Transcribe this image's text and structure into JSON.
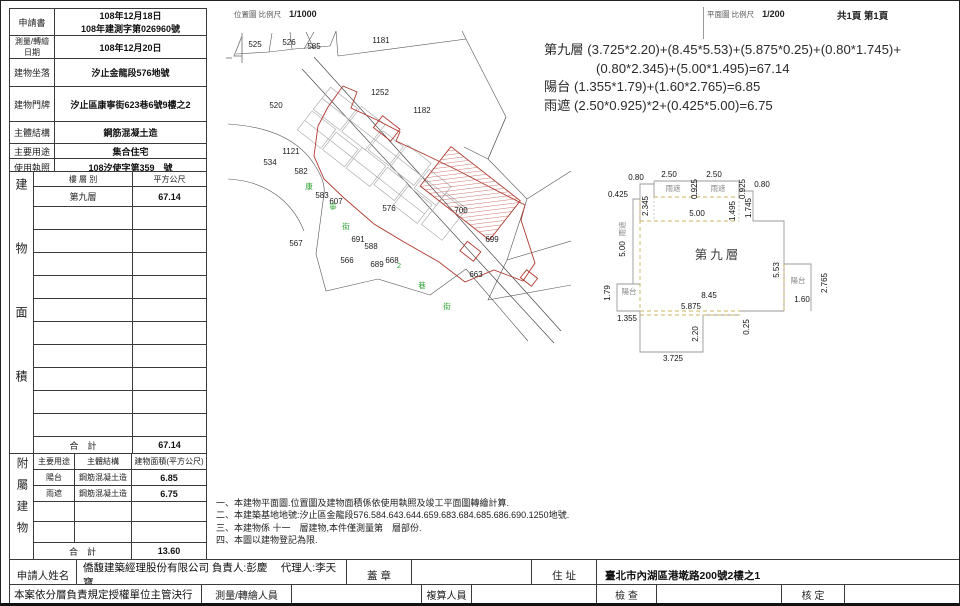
{
  "page": {
    "title_location": "位置圖 比例尺",
    "scale_location": "1/1000",
    "title_plan": "平面圖 比例尺",
    "scale_plan": "1/200",
    "page_info": "共1頁 第1頁"
  },
  "info_table": {
    "rows": [
      {
        "label": "申請書",
        "value": "108年12月18日",
        "value2": "108年建測字第026960號"
      },
      {
        "label": "測量/轉繪日期",
        "value": "108年12月20日"
      },
      {
        "label": "建物坐落",
        "value": "汐止金龍段576地號"
      },
      {
        "label": "建物門牌",
        "value": "汐止區康寧街623巷6號9樓之2"
      },
      {
        "label": "主體結構",
        "value": "鋼筋混凝土造"
      },
      {
        "label": "主要用途",
        "value": "集合住宅"
      },
      {
        "label": "使用執照",
        "value": "108汐使字第359　號"
      }
    ]
  },
  "area_table": {
    "side_label": "建物面積",
    "col1": "樓 層 別",
    "col2": "平方公尺",
    "rows": [
      {
        "floor": "第九層",
        "area": "67.14"
      }
    ],
    "total_label": "合　計",
    "total": "67.14"
  },
  "annex_table": {
    "side_label": "附屬建物",
    "headers": [
      "主要用途",
      "主體結構",
      "建物面積(平方公尺)"
    ],
    "rows": [
      {
        "use": "陽台",
        "structure": "鋼筋混凝土造",
        "area": "6.85"
      },
      {
        "use": "雨遮",
        "structure": "鋼筋混凝土造",
        "area": "6.75"
      }
    ],
    "total_label": "合　計",
    "total": "13.60"
  },
  "formulas": {
    "line1": "第九層 (3.725*2.20)+(8.45*5.53)+(5.875*0.25)+(0.80*1.745)+",
    "line2": "(0.80*2.345)+(5.00*1.495)=67.14",
    "line3": "陽台 (1.355*1.79)+(1.60*2.765)=6.85",
    "line4": "雨遮 (2.50*0.925)*2+(0.425*5.00)=6.75"
  },
  "notes": {
    "line1": "一、本建物平面圖.位置圖及建物面積係依使用執照及竣工平面圖轉繪計算.",
    "line2": "二、本建築基地地號:汐止區金龍段576.584.643.644.659.683.684.685.686.690.1250地號.",
    "line3": "三、本建物係 十一　層建物,本件僅測量第　層部份.",
    "line4": "四、本圖以建物登記為限."
  },
  "footer": {
    "applicant_label": "申請人姓名",
    "applicant_value": "僑馥建築經理股份有限公司 負責人:彭慶　 代理人:李天寶",
    "seal_label": "蓋 章",
    "address_label": "住 址",
    "address_value": "臺北市內湖區港墘路200號2樓之1",
    "row2_left": "本案依分層負責規定授權單位主管決行",
    "surveyor_label": "測量/轉繪人員",
    "recheck_label": "複算人員",
    "inspect_label": "檢 查",
    "approve_label": "核 定"
  },
  "map": {
    "parcels": [
      {
        "t": "525",
        "x": 29,
        "y": 18
      },
      {
        "t": "526",
        "x": 63,
        "y": 16
      },
      {
        "t": "585",
        "x": 88,
        "y": 20
      },
      {
        "t": "1181",
        "x": 155,
        "y": 14
      },
      {
        "t": "520",
        "x": 50,
        "y": 79
      },
      {
        "t": "1252",
        "x": 154,
        "y": 66
      },
      {
        "t": "1182",
        "x": 196,
        "y": 84
      },
      {
        "t": "534",
        "x": 44,
        "y": 136
      },
      {
        "t": "1121",
        "x": 65,
        "y": 125
      },
      {
        "t": "582",
        "x": 75,
        "y": 145
      },
      {
        "t": "583",
        "x": 96,
        "y": 169
      },
      {
        "t": "607",
        "x": 110,
        "y": 175
      },
      {
        "t": "576",
        "x": 163,
        "y": 182
      },
      {
        "t": "700",
        "x": 235,
        "y": 184
      },
      {
        "t": "567",
        "x": 70,
        "y": 217
      },
      {
        "t": "691",
        "x": 132,
        "y": 213
      },
      {
        "t": "588",
        "x": 145,
        "y": 220
      },
      {
        "t": "566",
        "x": 121,
        "y": 234
      },
      {
        "t": "689",
        "x": 151,
        "y": 238
      },
      {
        "t": "668",
        "x": 166,
        "y": 234
      },
      {
        "t": "699",
        "x": 266,
        "y": 213
      },
      {
        "t": "663",
        "x": 250,
        "y": 248
      }
    ],
    "streets": [
      {
        "t": "康",
        "x": 83,
        "y": 160
      },
      {
        "t": "寧",
        "x": 107,
        "y": 180
      },
      {
        "t": "街",
        "x": 120,
        "y": 200
      },
      {
        "t": "2",
        "x": 173,
        "y": 239
      },
      {
        "t": "巷",
        "x": 196,
        "y": 259
      },
      {
        "t": "街",
        "x": 221,
        "y": 280
      }
    ]
  },
  "plan": {
    "labels": [
      {
        "t": "0.80",
        "x": 40,
        "y": 24
      },
      {
        "t": "2.50",
        "x": 73,
        "y": 21
      },
      {
        "t": "0.925",
        "x": 101,
        "y": 33,
        "r": 1
      },
      {
        "t": "2.50",
        "x": 118,
        "y": 21
      },
      {
        "t": "0.925",
        "x": 149,
        "y": 33,
        "r": 1
      },
      {
        "t": "0.80",
        "x": 166,
        "y": 31
      },
      {
        "t": "0.425",
        "x": 22,
        "y": 41
      },
      {
        "t": "2.345",
        "x": 52,
        "y": 50,
        "r": 1
      },
      {
        "t": "5.00",
        "x": 101,
        "y": 60
      },
      {
        "t": "1.495",
        "x": 139,
        "y": 55,
        "r": 1
      },
      {
        "t": "1.745",
        "x": 155,
        "y": 52,
        "r": 1
      },
      {
        "t": "雨遮",
        "x": 77,
        "y": 35,
        "cls": "room"
      },
      {
        "t": "雨遮",
        "x": 122,
        "y": 35,
        "cls": "room"
      },
      {
        "t": "雨遮",
        "x": 29,
        "y": 73,
        "r": 1,
        "cls": "room"
      },
      {
        "t": "5.00",
        "x": 29,
        "y": 93,
        "r": 1
      },
      {
        "t": "第九層",
        "x": 122,
        "y": 103,
        "cls": "ptitle"
      },
      {
        "t": "5.53",
        "x": 183,
        "y": 114,
        "r": 1
      },
      {
        "t": "陽台",
        "x": 202,
        "y": 127,
        "cls": "room"
      },
      {
        "t": "2.765",
        "x": 231,
        "y": 127,
        "r": 1
      },
      {
        "t": "1.60",
        "x": 206,
        "y": 146
      },
      {
        "t": "1.79",
        "x": 14,
        "y": 137,
        "r": 1
      },
      {
        "t": "陽台",
        "x": 33,
        "y": 138,
        "cls": "room"
      },
      {
        "t": "8.45",
        "x": 113,
        "y": 142
      },
      {
        "t": "5.875",
        "x": 95,
        "y": 153
      },
      {
        "t": "1.355",
        "x": 31,
        "y": 165
      },
      {
        "t": "2.20",
        "x": 102,
        "y": 178,
        "r": 1
      },
      {
        "t": "0.25",
        "x": 153,
        "y": 171,
        "r": 1
      },
      {
        "t": "3.725",
        "x": 77,
        "y": 205
      }
    ]
  }
}
